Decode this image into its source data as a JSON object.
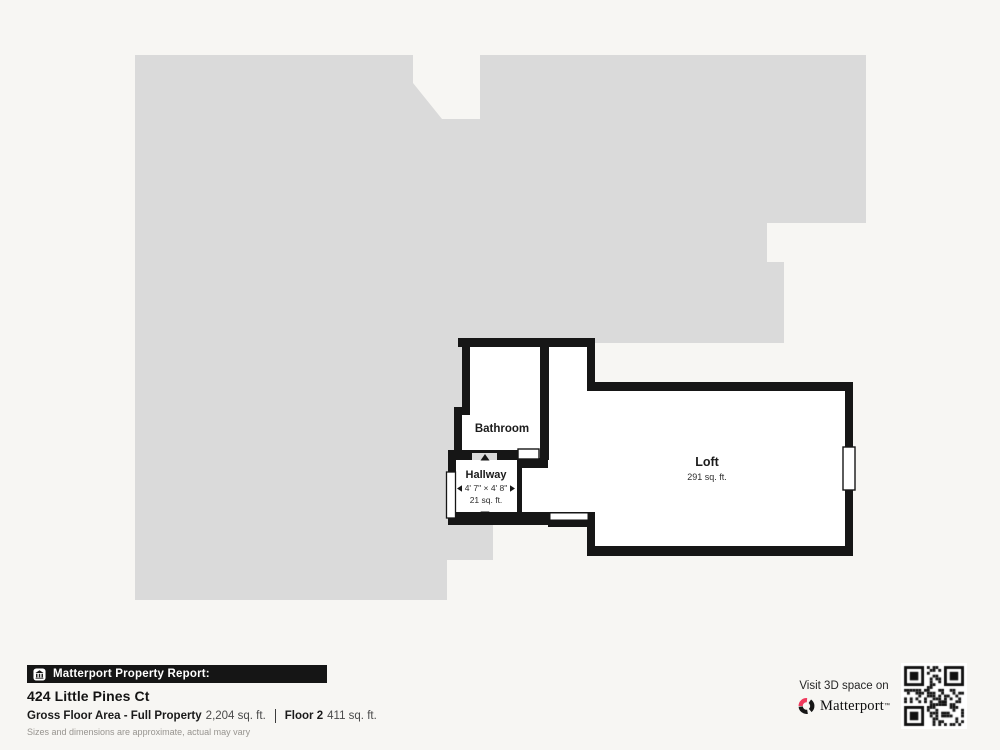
{
  "floor_plan": {
    "rooms": {
      "bathroom": {
        "label": "Bathroom"
      },
      "hallway": {
        "label": "Hallway",
        "dimensions": "4' 7\" × 4' 8\"",
        "area": "21 sq. ft."
      },
      "loft": {
        "label": "Loft",
        "area": "291 sq. ft."
      }
    },
    "colors": {
      "silhouette": "#dadada",
      "wall": "#161616",
      "room_fill": "#ffffff",
      "page_background": "#f7f6f3"
    }
  },
  "footer": {
    "report_bar": {
      "label": "Matterport Property Report:"
    },
    "address": "424 Little Pines Ct",
    "metrics": [
      {
        "label": "Gross Floor Area - Full Property",
        "value": "2,204 sq. ft."
      },
      {
        "label": "Floor 2",
        "value": "411 sq. ft."
      }
    ],
    "disclaimer": "Sizes and dimensions are approximate, actual may vary"
  },
  "promo": {
    "visit_text": "Visit 3D space on",
    "brand": "Matterport",
    "trademark": "™",
    "brand_color": "#ef3a5d",
    "qr_color": "#111111"
  }
}
